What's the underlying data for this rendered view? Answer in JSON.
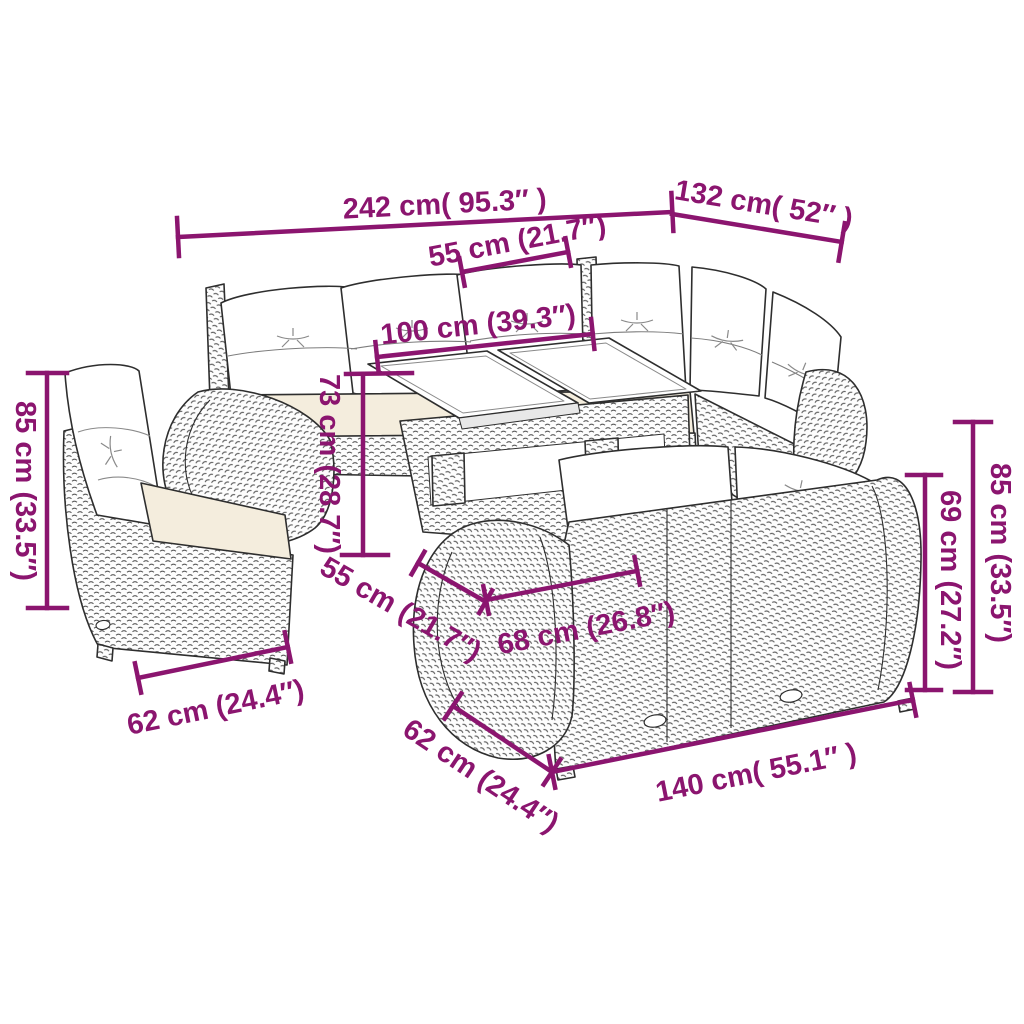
{
  "diagram_type": "furniture-dimension-diagram",
  "colors": {
    "dimension": "#8B156F",
    "outline": "#2e2e2e",
    "weave": "#595959",
    "cushion": "#ffffff",
    "seat_cushion": "#f4eddd",
    "background": "#ffffff"
  },
  "measurements": {
    "overall_width": "242 cm( 95.3″ )",
    "overall_depth": "132 cm( 52″ )",
    "seat_width": "55 cm (21.7″)",
    "table_length": "100 cm (39.3″)",
    "table_height": "73 cm (28.7″)",
    "seat_depth": "55 cm (21.7″)",
    "seat_front_depth": "68 cm (26.8″)",
    "armchair_depth": "62 cm (24.4″)",
    "sofa_depth": "62 cm (24.4″)",
    "sofa_width": "140 cm( 55.1″ )",
    "back_height": "69 cm (27.2″)",
    "total_height_right": "85 cm (33.5″)",
    "total_height_left": "85 cm (33.5″)"
  }
}
